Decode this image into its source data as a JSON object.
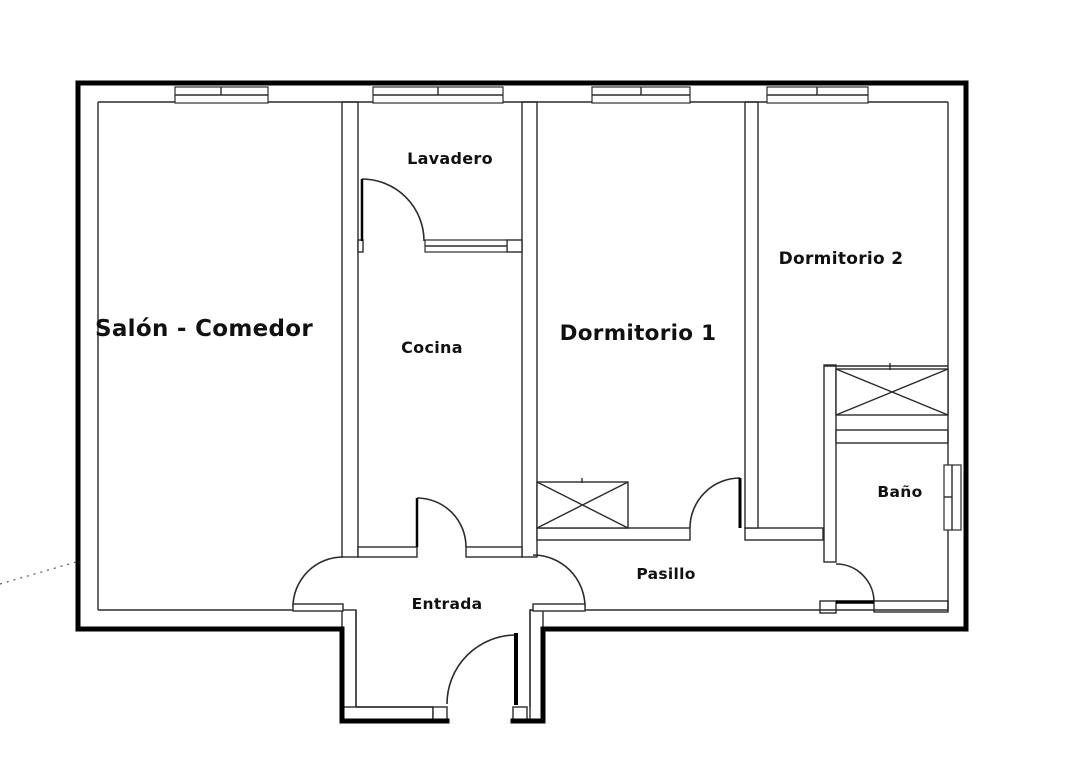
{
  "plan": {
    "rooms": {
      "salon": "Salón - Comedor",
      "lavadero": "Lavadero",
      "cocina": "Cocina",
      "dormitorio1": "Dormitorio 1",
      "dormitorio2": "Dormitorio 2",
      "bano": "Baño",
      "pasillo": "Pasillo",
      "entrada": "Entrada"
    },
    "colors": {
      "wall_outline": "#000000",
      "thin_line": "#2b2b2b",
      "background": "#ffffff",
      "text": "#111111"
    }
  }
}
